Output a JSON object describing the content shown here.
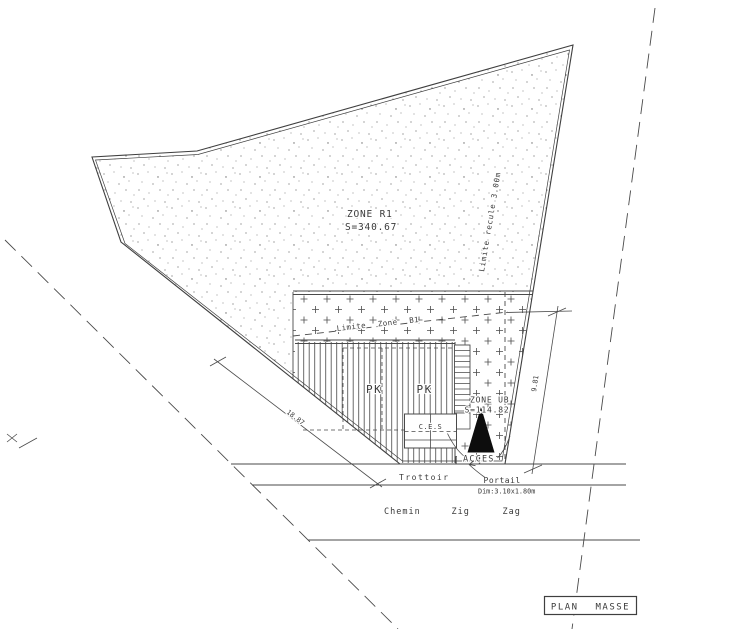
{
  "colors": {
    "ink": "#4a4a4a",
    "paper": "#ffffff",
    "triangle": "#0d0d0d"
  },
  "title_block": {
    "label": "PLAN MASSE"
  },
  "zone_r1": {
    "name": "ZONE R1",
    "area": "S=340.67"
  },
  "zone_ub": {
    "name": "ZONE UB",
    "area": "S=114.82"
  },
  "labels": {
    "limite_recule": "Limite recule 3.00m",
    "limite_zone_b1": "Limite Zone B1",
    "pk_left": "PK",
    "pk_right": "PK",
    "ces": "C.E.S",
    "acces": "ACCES",
    "trottoir": "Trottoir",
    "portail": "Portail",
    "portail_dim": "Dim:3.10x1.80m",
    "chemin": "Chemin",
    "zig": "Zig",
    "zag": "Zag"
  },
  "dimensions": {
    "street_frontage": "18.87",
    "side_depth": "9.81"
  }
}
